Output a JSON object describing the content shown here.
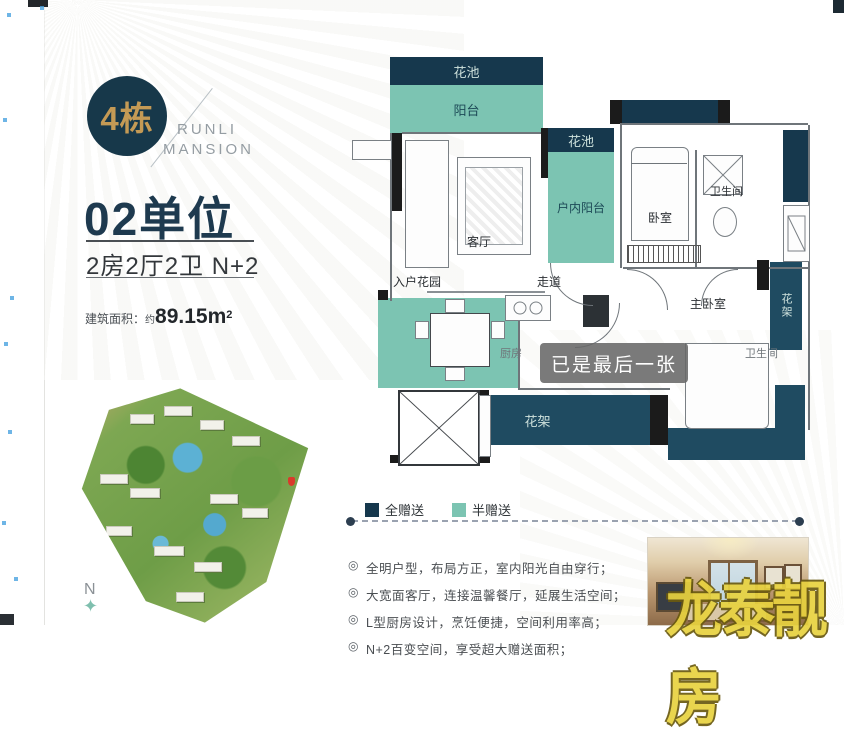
{
  "left": {
    "badge": "4栋",
    "brand_line1": "RUNLI",
    "brand_line2": "MANSION",
    "unit_title": "02单位",
    "unit_spec": "2房2厅2卫 N+2",
    "area_label": "建筑面积：",
    "area_prefix": "约",
    "area_value": "89.15m",
    "area_sup": "2",
    "compass_n": "N",
    "compass_star": "✦"
  },
  "fp": {
    "flower_top": "花池",
    "balcony": "阳台",
    "flower_right": "花池",
    "indoor_balcony": "户内阳台",
    "living": "客厅",
    "entry_garden": "入户花园",
    "corridor": "走道",
    "bedroom": "卧室",
    "bath": "卫生间",
    "master": "主卧室",
    "rack_right": "花架",
    "rack_bottom": "花架",
    "kitchen": "厨房",
    "bath2": "卫生间",
    "toast": "已是最后一张"
  },
  "legend": {
    "full": "全赠送",
    "half": "半赠送",
    "full_color": "#16384d",
    "half_color": "#7cc4b2"
  },
  "features": {
    "bullet": "◎",
    "items": [
      {
        "text": "全明户型，布局方正，室内阳光自由穿行；"
      },
      {
        "text": "大宽面客厅，连接温馨餐厅，延展生活空间；"
      },
      {
        "text": "L型厨房设计，烹饪便捷，空间利用率高；"
      },
      {
        "text": "N+2百变空间，享受超大赠送面积；"
      }
    ]
  },
  "watermark": "龙泰靓房",
  "colors": {
    "navy": "#16384d",
    "teal": "#7cc4b2",
    "gold": "#c49a55"
  }
}
